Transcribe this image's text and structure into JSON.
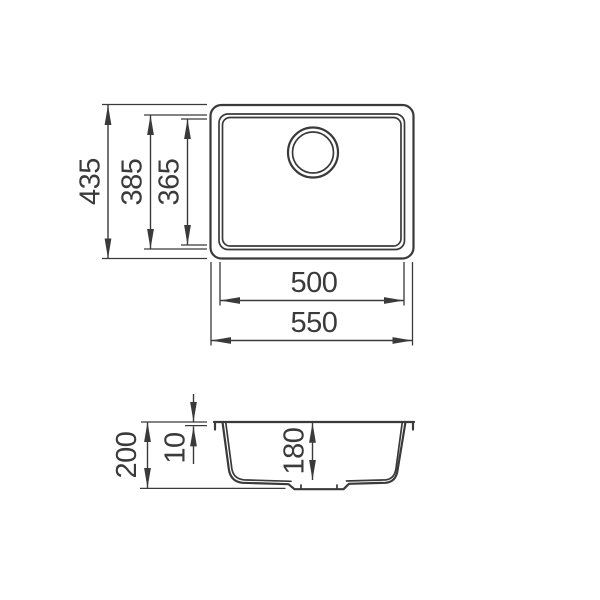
{
  "top_view": {
    "overall_height": "435",
    "rim_height": "385",
    "bowl_height": "365",
    "bowl_width": "500",
    "overall_width": "550"
  },
  "section_view": {
    "overall_depth": "200",
    "rim_thickness": "10",
    "bowl_depth": "180"
  },
  "colors": {
    "line": "#3a3a3a",
    "background": "#ffffff"
  }
}
